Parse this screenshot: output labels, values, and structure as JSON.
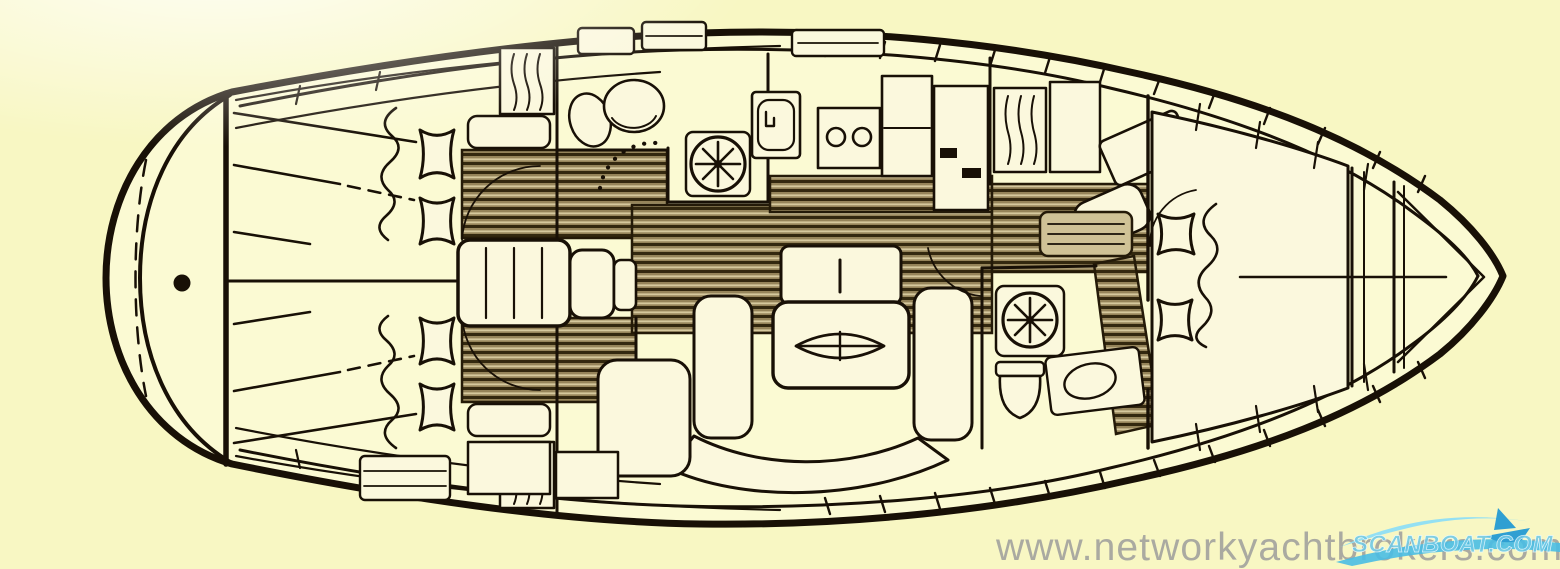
{
  "meta": {
    "description": "Scanned sailing-yacht interior layout plan, top view, bow pointing right"
  },
  "watermark": {
    "text": "www.networkyachtbrokers.com"
  },
  "logo": {
    "text": "SCANBOAT.COM"
  },
  "colors": {
    "background": "#f8f7c3",
    "line": "#181006",
    "interior": "#fbfad3",
    "furniture": "#fbf8dd",
    "teak_base": "#95845a",
    "teak_dark": "#33280f",
    "teak_light": "#d5c89d",
    "watermark_gray": "#9a9a9a",
    "logo_blue": "#6fc9e6",
    "logo_blue_dark": "#2f9fd2"
  },
  "icons": {
    "shower-drain-icon": "circle with 8 radial spokes",
    "toilet-icon": "rounded bowl outline",
    "sink-icon": "oval basin",
    "stove-burners-icon": "two circles in a rectangle",
    "hanging-locker-icon": "three wavy vertical lines in a box",
    "berth-cushion-icon": "pin-cushion square with concave sides",
    "saloon-table-icon": "rounded rectangle with lens-shaped inlay",
    "rudder-post-icon": "solid dot",
    "sailboat-logo-icon": "small sailboat over wave swoosh"
  }
}
